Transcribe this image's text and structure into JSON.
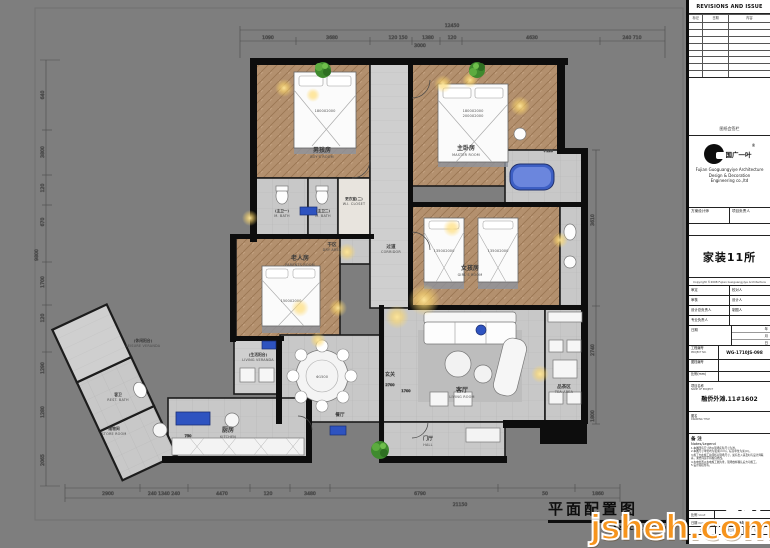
{
  "sheet_title": {
    "cn": "平面配置图",
    "scale": "A2  SCALE:1:50"
  },
  "watermark": {
    "brand": "jsheh.com",
    "brand_cn": "聚设汇"
  },
  "titleblock": {
    "revisions_header": "REVISIONS AND ISSUE DATES",
    "rev_cols": [
      "标记",
      "日期",
      "内容"
    ],
    "sign_note": "图纸会签栏",
    "logo_cn": "国广一叶",
    "logo_reg": "®",
    "company_en_1": "Fujian Guoguangyiye Architecture",
    "company_en_2": "Design & Decoration",
    "company_en_3": "Engineering co.,ltd",
    "designer_label": "方案设计师",
    "pm_label": "项目负责人",
    "dept": "家装11所",
    "copyright": "Copyright ©2008 Fujian Guoguangyiye Architecture",
    "pairs": [
      {
        "l": "审定",
        "r": "校对人"
      },
      {
        "l": "审核",
        "r": "设计人"
      },
      {
        "l": "设计总负责人",
        "r": "制图人"
      },
      {
        "l": "专业负责人",
        "r": ""
      }
    ],
    "date_label": "日期",
    "date_units": [
      "年",
      "月",
      "日"
    ],
    "project_no_label": "工程编号",
    "project_no_sub": "PROJECT NO.",
    "project_no": "WG-1710JS-098",
    "doc_no_label": "图档编号",
    "scale_mm_label": "比例(mm)",
    "project_name_label": "项目名称",
    "project_name_sub": "NAME OF PROJECT",
    "project_name": "融侨外滩.11#1602",
    "figure_label": "图名",
    "figure_sub": "DRAWING TITLE",
    "notes_title": "备 注",
    "notes_sub": "Notes/Legend",
    "notes": [
      "1.本图所有尺寸均以现场实际尺寸为准。",
      "2.本图尺寸单位均为毫米(mm)，标高单位为米(m)。",
      "3.施工方在施工前须核对现场尺寸，如有出入请及时与设计师联系，未经同意不得擅自修改。",
      "4.水电位置以水电施工图为准，现场放样确认后方可施工。",
      "5.设计版权所有。"
    ],
    "scale_row_label": "比例",
    "scale_row_sub": "SCALE",
    "date_row_label": "日期",
    "date_row_sub": "DATE",
    "date_value": "2018年06月",
    "tiny_cols": [
      "会签",
      "出图日期",
      "版次"
    ]
  },
  "dims": {
    "top_total": "12450",
    "top": [
      "1090",
      "3680",
      "120 150",
      "1380",
      "120",
      "4630",
      "240 710"
    ],
    "top_sub": "3000",
    "left_total": "9800",
    "left": [
      "640",
      "3800",
      "120",
      "670",
      "1700",
      "120",
      "1290",
      "1280",
      "2065"
    ],
    "bottom_total": "21150",
    "bottom": [
      "2900",
      "240 1340 240",
      "4470",
      "120",
      "3480",
      "6790",
      "50",
      "1860"
    ],
    "right": [
      "3610",
      "2740",
      "1800"
    ],
    "misc": {
      "counter": "750",
      "foyer_a": "2700",
      "foyer_b": "1700",
      "bath_level": "+120"
    }
  },
  "plan": {
    "rooms": [
      {
        "cn": "男孩房",
        "en": "BOY'S ROOM"
      },
      {
        "cn": "主卧房",
        "en": "MASTER ROOM"
      },
      {
        "cn": "女孩房",
        "en": "GIRL'S ROOM"
      },
      {
        "cn": "老人房",
        "en": "PARENTS ROOM"
      },
      {
        "cn": "客厅",
        "en": "LIVING ROOM"
      },
      {
        "cn": "品茶区",
        "en": "TEA AREA"
      },
      {
        "cn": "玄关",
        "en": ""
      },
      {
        "cn": "门厅",
        "en": "HALL"
      },
      {
        "cn": "餐厅",
        "en": "DINING ROOM"
      },
      {
        "cn": "厨房",
        "en": "KITCHEN"
      },
      {
        "cn": "过道",
        "en": "CORRIDOR"
      },
      {
        "cn": "干区",
        "en": "DRY AREA"
      },
      {
        "cn": "(生活阳台)",
        "en": "LIVING VERANDA"
      },
      {
        "cn": "(休闲阳台)",
        "en": "LEISURE VERANDA"
      },
      {
        "cn": "客卫",
        "en": "REST. BATH"
      },
      {
        "cn": "储物间",
        "en": "STORE ROOM"
      },
      {
        "cn": "(主卫一)",
        "en": "M. BATH"
      },
      {
        "cn": "(主卫二)",
        "en": "M. BATH"
      },
      {
        "cn": "更衣室(二)",
        "en": "W.I. CLOSET"
      }
    ],
    "furniture": {
      "bed_boy": "1800X2000",
      "bed_master_a": "1800X2000",
      "bed_master_b": "2000X2000",
      "bed_girl_a": "1350X2000",
      "bed_girl_b": "1350X2000",
      "bed_parents": "1500X2000",
      "table_dining": "Φ1500"
    }
  }
}
